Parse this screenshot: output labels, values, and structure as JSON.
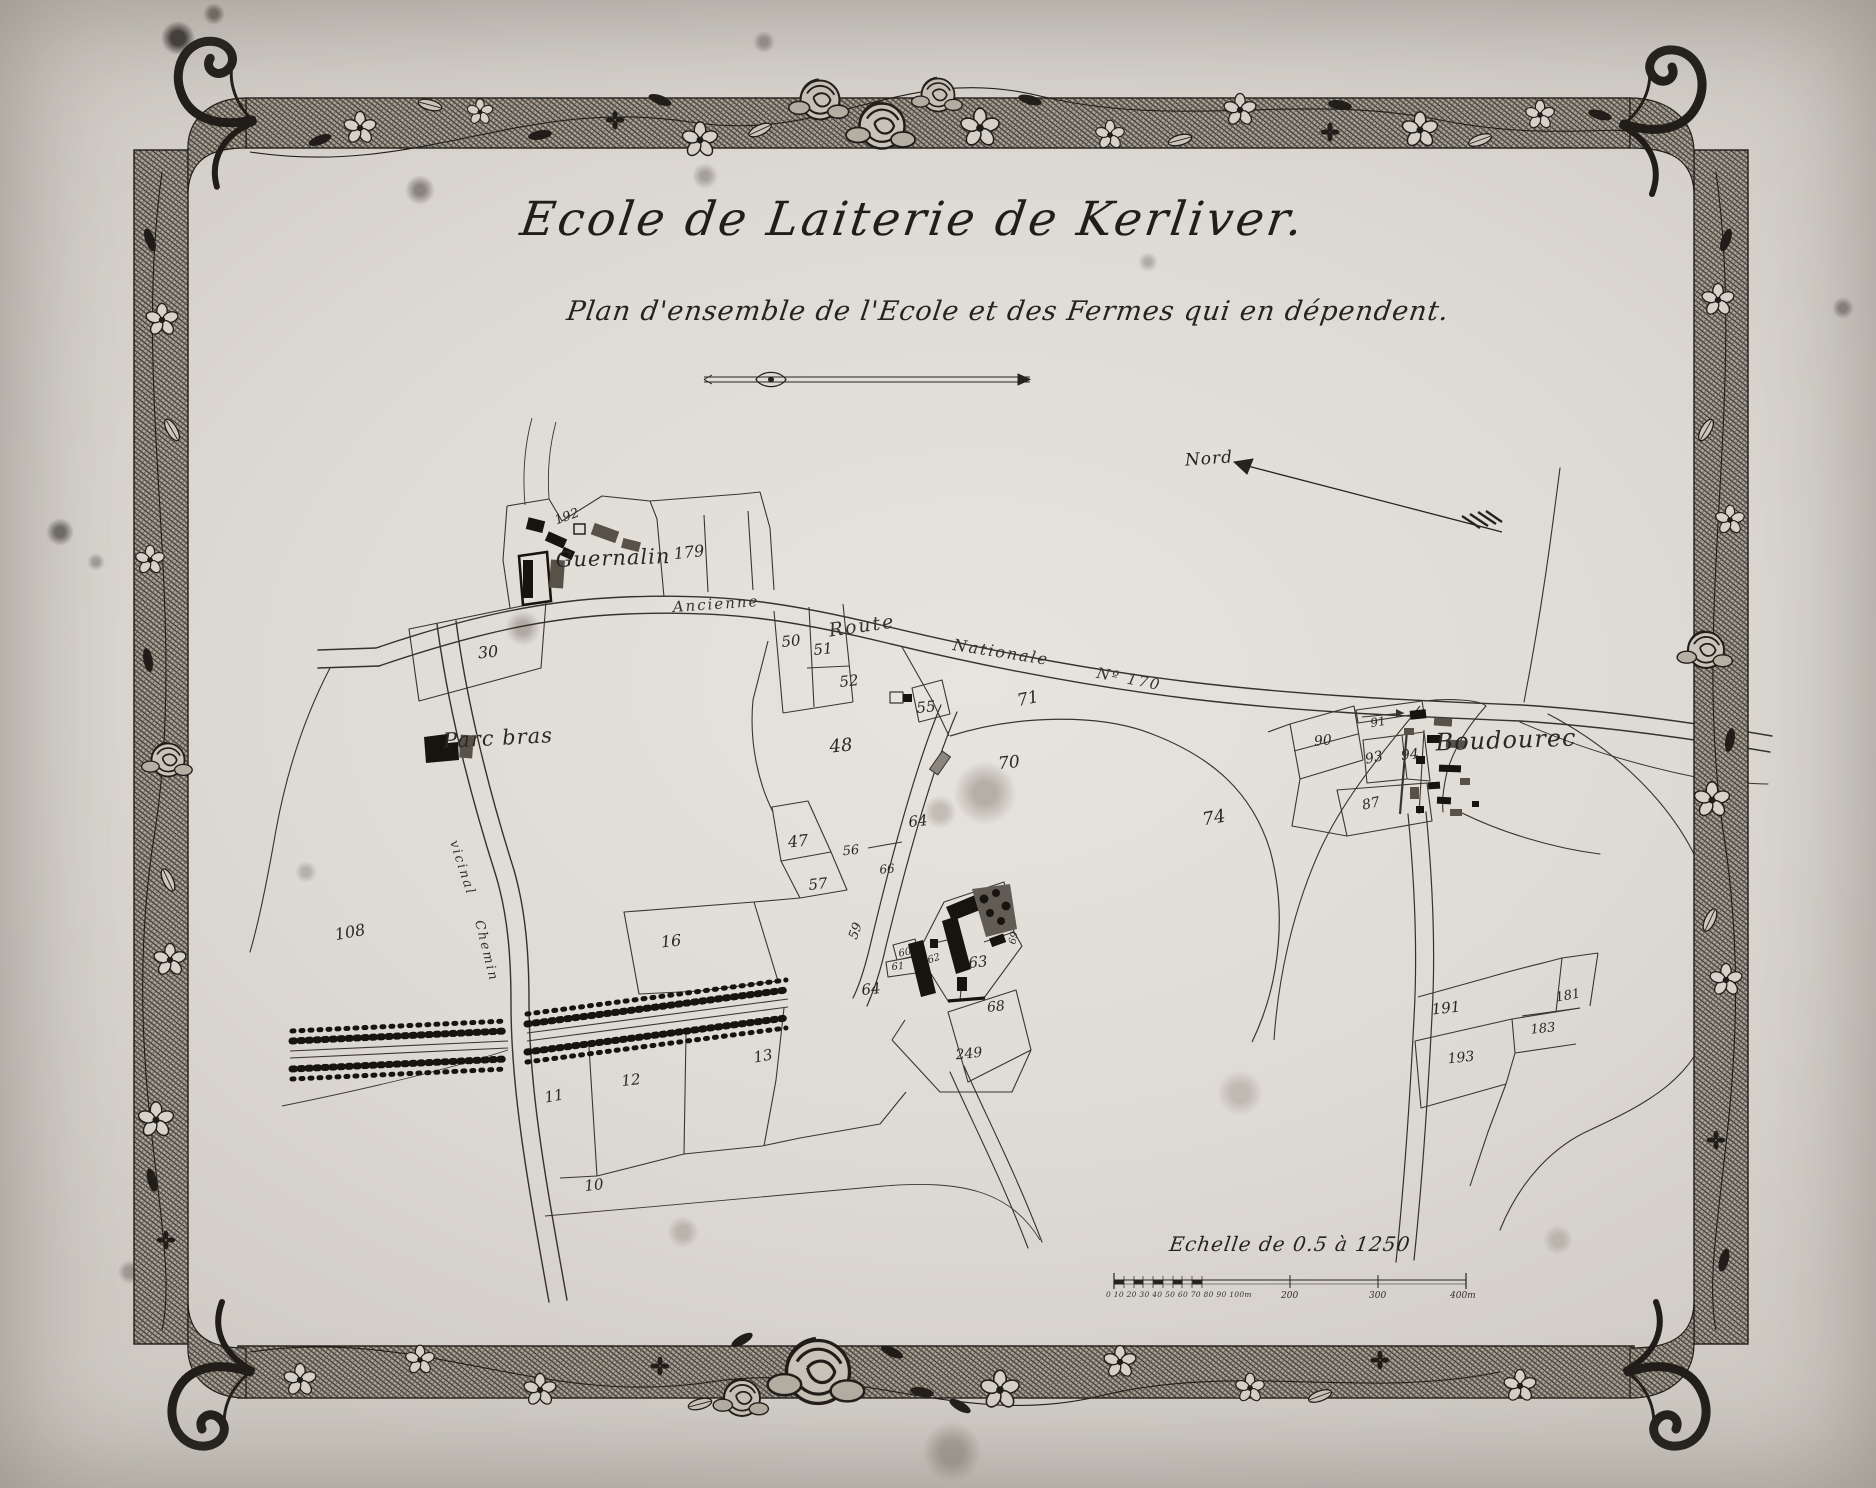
{
  "colors": {
    "ink": "#26221d",
    "paper": "#dedad4",
    "building_dark": "#17140f",
    "building_hatch": "#575147"
  },
  "header": {
    "title": "Ecole de Laiterie de Kerliver.",
    "subtitle": "Plan d'ensemble de l'Ecole et des Fermes qui en dépendent."
  },
  "compass": {
    "label": "Nord"
  },
  "scale_bar": {
    "caption": "Echelle de 0.5 à 1250",
    "left_ticks": "0 10 20 30 40 50 60 70 80 90 100m",
    "tick_200": "200",
    "tick_300": "300",
    "tick_400": "400m"
  },
  "map": {
    "place_names": [
      {
        "label": "Guernalin",
        "x": 613,
        "y": 558,
        "size": 21,
        "rot": -2
      },
      {
        "label": "Parc bras",
        "x": 498,
        "y": 738,
        "size": 21,
        "rot": -3
      },
      {
        "label": "Boudourec",
        "x": 1506,
        "y": 740,
        "size": 24,
        "rot": -2
      }
    ],
    "road_labels": [
      {
        "label": "Ancienne",
        "x": 716,
        "y": 604,
        "size": 15,
        "rot": -4
      },
      {
        "label": "Route",
        "x": 862,
        "y": 626,
        "size": 19,
        "rot": -8
      },
      {
        "label": "Nationale",
        "x": 1001,
        "y": 652,
        "size": 16,
        "rot": 9
      },
      {
        "label": "Nº 170",
        "x": 1129,
        "y": 679,
        "size": 15,
        "rot": 11
      },
      {
        "label": "vicinal",
        "x": 462,
        "y": 868,
        "size": 13,
        "rot": 72
      },
      {
        "label": "Chemin",
        "x": 486,
        "y": 951,
        "size": 13,
        "rot": 76
      }
    ],
    "parcel_numbers": [
      {
        "label": "192",
        "x": 567,
        "y": 517,
        "size": 13,
        "rot": -20
      },
      {
        "label": "179",
        "x": 689,
        "y": 552,
        "size": 16
      },
      {
        "label": "30",
        "x": 488,
        "y": 652,
        "size": 16
      },
      {
        "label": "50",
        "x": 791,
        "y": 641,
        "size": 15
      },
      {
        "label": "51",
        "x": 823,
        "y": 649,
        "size": 15
      },
      {
        "label": "52",
        "x": 849,
        "y": 681,
        "size": 15
      },
      {
        "label": "55",
        "x": 926,
        "y": 707,
        "size": 15
      },
      {
        "label": "71",
        "x": 1028,
        "y": 699,
        "size": 17,
        "rot": -12
      },
      {
        "label": "48",
        "x": 841,
        "y": 746,
        "size": 18
      },
      {
        "label": "70",
        "x": 1009,
        "y": 763,
        "size": 17
      },
      {
        "label": "64",
        "x": 918,
        "y": 821,
        "size": 15
      },
      {
        "label": "74",
        "x": 1214,
        "y": 818,
        "size": 18,
        "rot": -10
      },
      {
        "label": "47",
        "x": 798,
        "y": 841,
        "size": 16
      },
      {
        "label": "56",
        "x": 851,
        "y": 851,
        "size": 13
      },
      {
        "label": "66",
        "x": 887,
        "y": 869,
        "size": 12
      },
      {
        "label": "57",
        "x": 818,
        "y": 884,
        "size": 15
      },
      {
        "label": "59",
        "x": 856,
        "y": 931,
        "size": 13,
        "rot": -70
      },
      {
        "label": "60",
        "x": 905,
        "y": 953,
        "size": 10,
        "rot": -12
      },
      {
        "label": "61",
        "x": 898,
        "y": 967,
        "size": 10
      },
      {
        "label": "62",
        "x": 934,
        "y": 959,
        "size": 10,
        "rot": -18
      },
      {
        "label": "69",
        "x": 1014,
        "y": 938,
        "size": 10,
        "rot": -78
      },
      {
        "label": "63",
        "x": 978,
        "y": 962,
        "size": 15
      },
      {
        "label": "64",
        "x": 871,
        "y": 989,
        "size": 15
      },
      {
        "label": "68",
        "x": 996,
        "y": 1007,
        "size": 14
      },
      {
        "label": "249",
        "x": 969,
        "y": 1054,
        "size": 14
      },
      {
        "label": "108",
        "x": 350,
        "y": 932,
        "size": 16,
        "rot": -10
      },
      {
        "label": "16",
        "x": 671,
        "y": 941,
        "size": 16
      },
      {
        "label": "13",
        "x": 763,
        "y": 1056,
        "size": 15,
        "rot": -10
      },
      {
        "label": "12",
        "x": 631,
        "y": 1080,
        "size": 15
      },
      {
        "label": "11",
        "x": 554,
        "y": 1096,
        "size": 15,
        "rot": -10
      },
      {
        "label": "10",
        "x": 594,
        "y": 1185,
        "size": 15
      },
      {
        "label": "90",
        "x": 1323,
        "y": 741,
        "size": 14
      },
      {
        "label": "91",
        "x": 1378,
        "y": 722,
        "size": 12,
        "rot": -10
      },
      {
        "label": "93",
        "x": 1374,
        "y": 758,
        "size": 14,
        "rot": -12
      },
      {
        "label": "94",
        "x": 1410,
        "y": 755,
        "size": 14
      },
      {
        "label": "87",
        "x": 1371,
        "y": 804,
        "size": 14,
        "rot": -12
      },
      {
        "label": "191",
        "x": 1446,
        "y": 1008,
        "size": 15
      },
      {
        "label": "181",
        "x": 1568,
        "y": 996,
        "size": 13,
        "rot": -10
      },
      {
        "label": "183",
        "x": 1543,
        "y": 1029,
        "size": 13
      },
      {
        "label": "193",
        "x": 1461,
        "y": 1058,
        "size": 14
      }
    ]
  }
}
